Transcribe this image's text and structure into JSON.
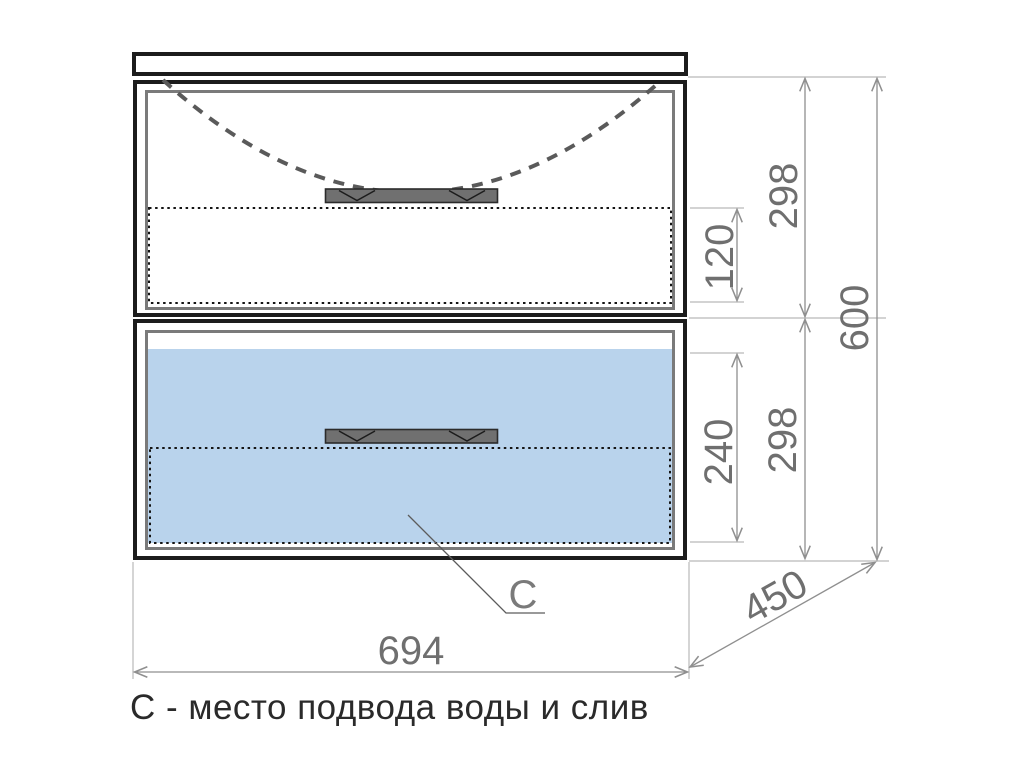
{
  "caption": "С - место подвода воды и слив",
  "leader": {
    "label": "C"
  },
  "dimensions": {
    "overall_width": "694",
    "overall_depth": "450",
    "overall_height": "600",
    "top_drawer_front": "298",
    "bottom_drawer_front": "298",
    "top_drawer_inner": "120",
    "bottom_drawer_inner": "240"
  },
  "colors": {
    "outline": "#1c1c1c",
    "frame": "#7a7a7a",
    "highlight": "#b9d3ec",
    "ext": "#b9b9b9",
    "dim": "#8f8f8f",
    "dimtext": "#6f6f6f",
    "handle": "#707070",
    "caption": "#2a2a2a",
    "leader": "#5c5c5c",
    "label": "#7a7a7a",
    "sink": "#5a5a5a",
    "dotted": "#141414"
  }
}
